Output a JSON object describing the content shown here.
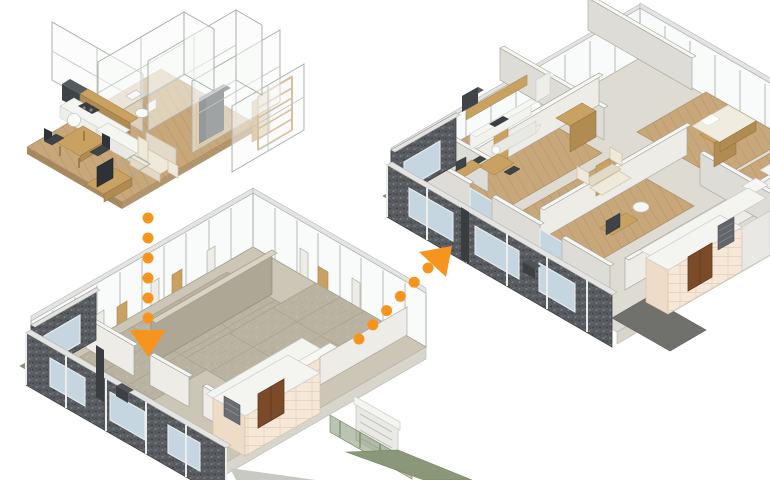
{
  "scene": {
    "background": "#ffffff",
    "canvas": {
      "width": 770,
      "height": 480
    }
  },
  "palette": {
    "orange": "#F7941E",
    "wood-floor": "#C8A87A",
    "wood": "#C9A262",
    "wood-dark": "#B08B52",
    "wall-top": "#F6F6F3",
    "wall-se": "#EDECE7",
    "wall-sw": "#DDDCD6",
    "wall-stroke": "#A2A19B",
    "concrete": "#CCC6B7",
    "concrete-dark": "#BAB3A1",
    "concrete-wall": "#AEA796",
    "glass-blue": "#C6D6E0",
    "panel-dark": "#54585C",
    "tile-color": "#F6E8D8",
    "door-brown": "#7B4A28",
    "grass": "#8A9778",
    "white": "#F7F7F4",
    "dark": "#3E4347",
    "sofa": "#EFE9D9",
    "slab-side": "#D8D5CD"
  },
  "models": [
    {
      "id": "unit-interior-model",
      "position": "top-left"
    },
    {
      "id": "structural-floor-model",
      "position": "bottom-center"
    },
    {
      "id": "full-floor-model",
      "position": "top-right"
    }
  ],
  "arrows": [
    {
      "name": "arrow-down",
      "color": "#F7941E",
      "dot_count": 6,
      "dot_radius": 5.5,
      "x1": 148,
      "y1": 218,
      "x2": 148,
      "y2": 318,
      "head_points": "130,330 166,330 148,357"
    },
    {
      "name": "arrow-up-right",
      "color": "#F7941E",
      "dot_count": 6,
      "dot_radius": 5.5,
      "x1": 359,
      "y1": 339,
      "x2": 428,
      "y2": 268,
      "head_points": "452,246 446,277 419,252"
    }
  ]
}
